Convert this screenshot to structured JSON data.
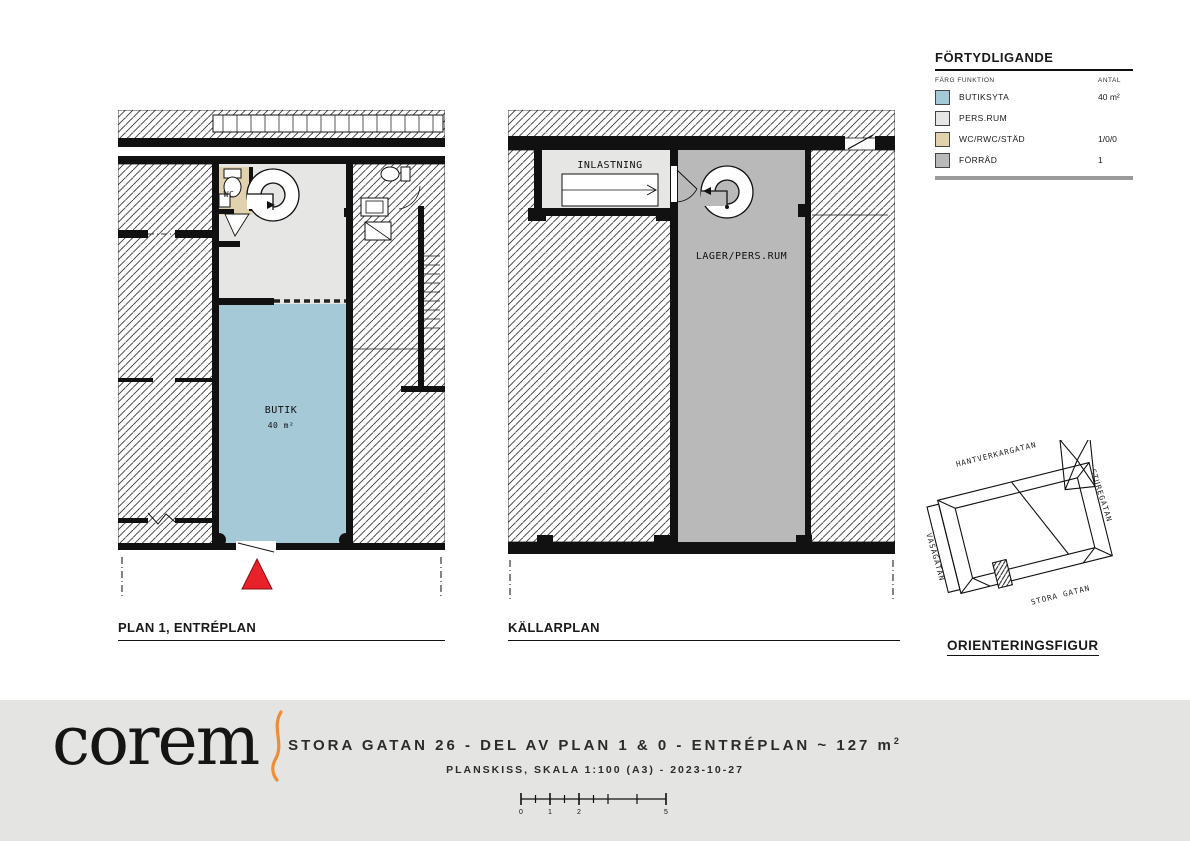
{
  "colors": {
    "butik": "#a5c9d7",
    "persrum": "#e6e6e4",
    "wc": "#e0d2ac",
    "forrad": "#b9b9b9",
    "entry_red": "#e8212b",
    "logo_orange": "#ef8c34",
    "footer_bg": "#e4e4e2"
  },
  "legend": {
    "title": "FÖRTYDLIGANDE",
    "col_left": "FÄRG  FUNKTION",
    "col_right": "ANTAL",
    "rows": [
      {
        "label": "BUTIKSYTA",
        "value": "40 m²",
        "color": "#a5c9d7"
      },
      {
        "label": "PERS.RUM",
        "value": "",
        "color": "#e6e6e4"
      },
      {
        "label": "WC/RWC/STÄD",
        "value": "1/0/0",
        "color": "#e0d2ac"
      },
      {
        "label": "FÖRRÅD",
        "value": "1",
        "color": "#b9b9b9"
      }
    ]
  },
  "plan1": {
    "title": "PLAN 1, ENTRÉPLAN",
    "wc_label": "WC",
    "butik_label": "BUTIK",
    "butik_area": "40 m²"
  },
  "plan2": {
    "title": "KÄLLARPLAN",
    "inlastning_label": "INLASTNING",
    "lager_label": "LAGER/PERS.RUM"
  },
  "orientation": {
    "title": "ORIENTERINGSFIGUR",
    "streets": {
      "top": "HANTVERKARGATAN",
      "right": "STUREGATAN",
      "left": "VASAGATAN",
      "bottom": "STORA GATAN"
    }
  },
  "footer": {
    "logo": "corem",
    "title": "STORA GATAN 26 - DEL AV PLAN 1 & 0 - ENTRÉPLAN ~ 127 m",
    "title_sup": "2",
    "subtitle": "PLANSKISS, SKALA 1:100 (A3) - 2023-10-27",
    "scale_labels": [
      "0",
      "1",
      "2",
      "5"
    ]
  }
}
